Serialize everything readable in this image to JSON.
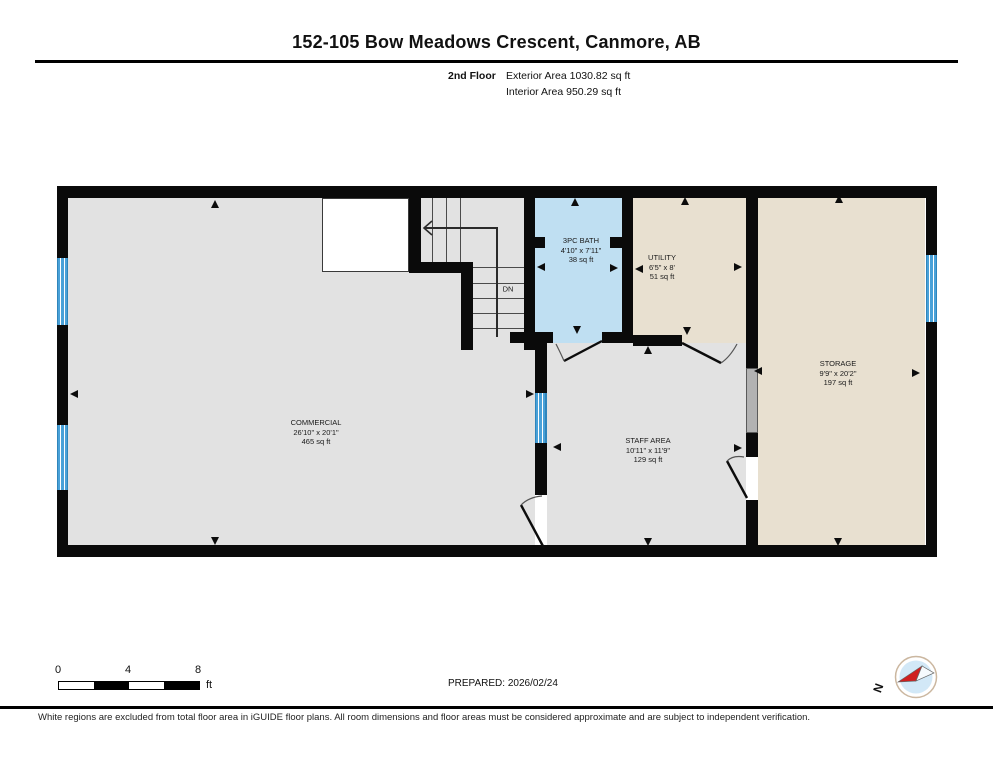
{
  "header": {
    "title": "152-105 Bow Meadows Crescent, Canmore, AB",
    "floor_label": "2nd Floor",
    "exterior_area": "Exterior Area 1030.82 sq ft",
    "interior_area": "Interior Area 950.29 sq ft"
  },
  "rooms": [
    {
      "name": "COMMERCIAL",
      "dims": "26'10\" x 20'1\"",
      "area": "465 sq ft"
    },
    {
      "name": "3PC BATH",
      "dims": "4'10\" x 7'11\"",
      "area": "38 sq ft"
    },
    {
      "name": "UTILITY",
      "dims": "6'5\" x 8'",
      "area": "51 sq ft"
    },
    {
      "name": "STORAGE",
      "dims": "9'9\" x 20'2\"",
      "area": "197 sq ft"
    },
    {
      "name": "STAFF AREA",
      "dims": "10'11\" x 11'9\"",
      "area": "129 sq ft"
    }
  ],
  "stairs": {
    "down_label": "DN"
  },
  "scale_bar": {
    "ticks": [
      "0",
      "4",
      "8"
    ],
    "unit": "ft"
  },
  "prepared": "PREPARED: 2026/02/24",
  "compass": {
    "north_label": "N"
  },
  "disclaimer": "White regions are excluded from total floor area in iGUIDE floor plans. All room dimensions and floor areas must be considered approximate and are subject to independent verification.",
  "colors": {
    "wall": "#0a0a0a",
    "room_gray": "#e2e2e2",
    "bath_blue": "#bfdff2",
    "beige": "#e8e0d0",
    "window_blue": "#49a1d8",
    "excluded_white": "#ffffff",
    "needle_red": "#cf1f1f"
  }
}
